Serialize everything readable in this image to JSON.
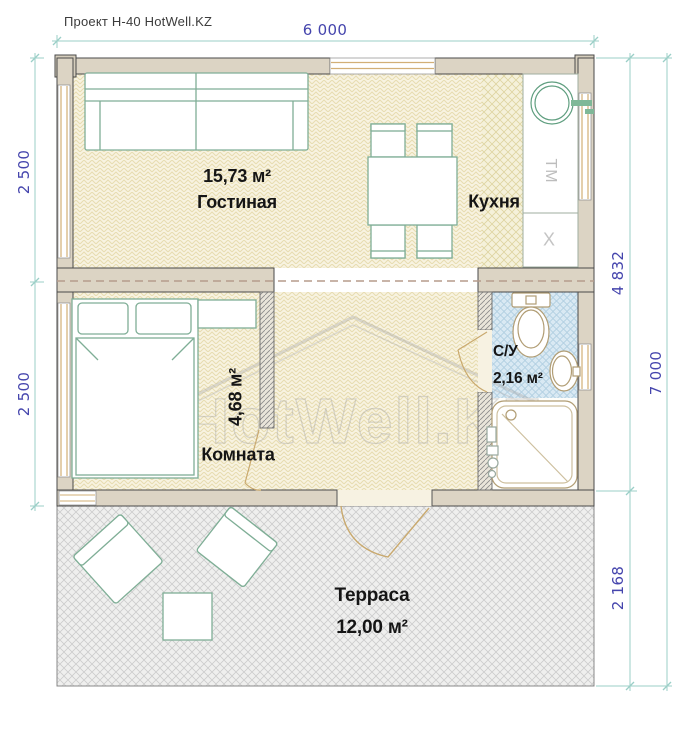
{
  "title": "Проект Н-40 HotWell.KZ",
  "watermark": "HotWell.KZ",
  "dimensions": {
    "top_width": "6 000",
    "left_upper": "2 500",
    "left_lower": "2 500",
    "right_house_depth": "4 832",
    "right_terrace_depth": "2 168",
    "right_total_depth": "7 000"
  },
  "rooms": {
    "living": {
      "area": "15,73 м²",
      "name": "Гостиная"
    },
    "kitchen": {
      "name": "Кухня"
    },
    "bedroom": {
      "area": "4,68 м²",
      "name": "Комната"
    },
    "bathroom": {
      "name": "С/У",
      "area": "2,16 м²"
    },
    "terrace": {
      "name": "Терраса",
      "area": "12,00 м²"
    }
  },
  "appliances": {
    "washing_machine": "ТМ",
    "stove": "X"
  },
  "colors": {
    "dimension_text": "#4545ad",
    "dimension_line": "#9bcfc7",
    "wall_fill": "#dcd4c4",
    "furniture_stroke": "#7fae96",
    "sanitary_stroke": "#b19d74",
    "bathroom_tile": "#d9e9f3",
    "window_frame": "#d2af76",
    "terrace_hatch": "#cbcbcb"
  }
}
